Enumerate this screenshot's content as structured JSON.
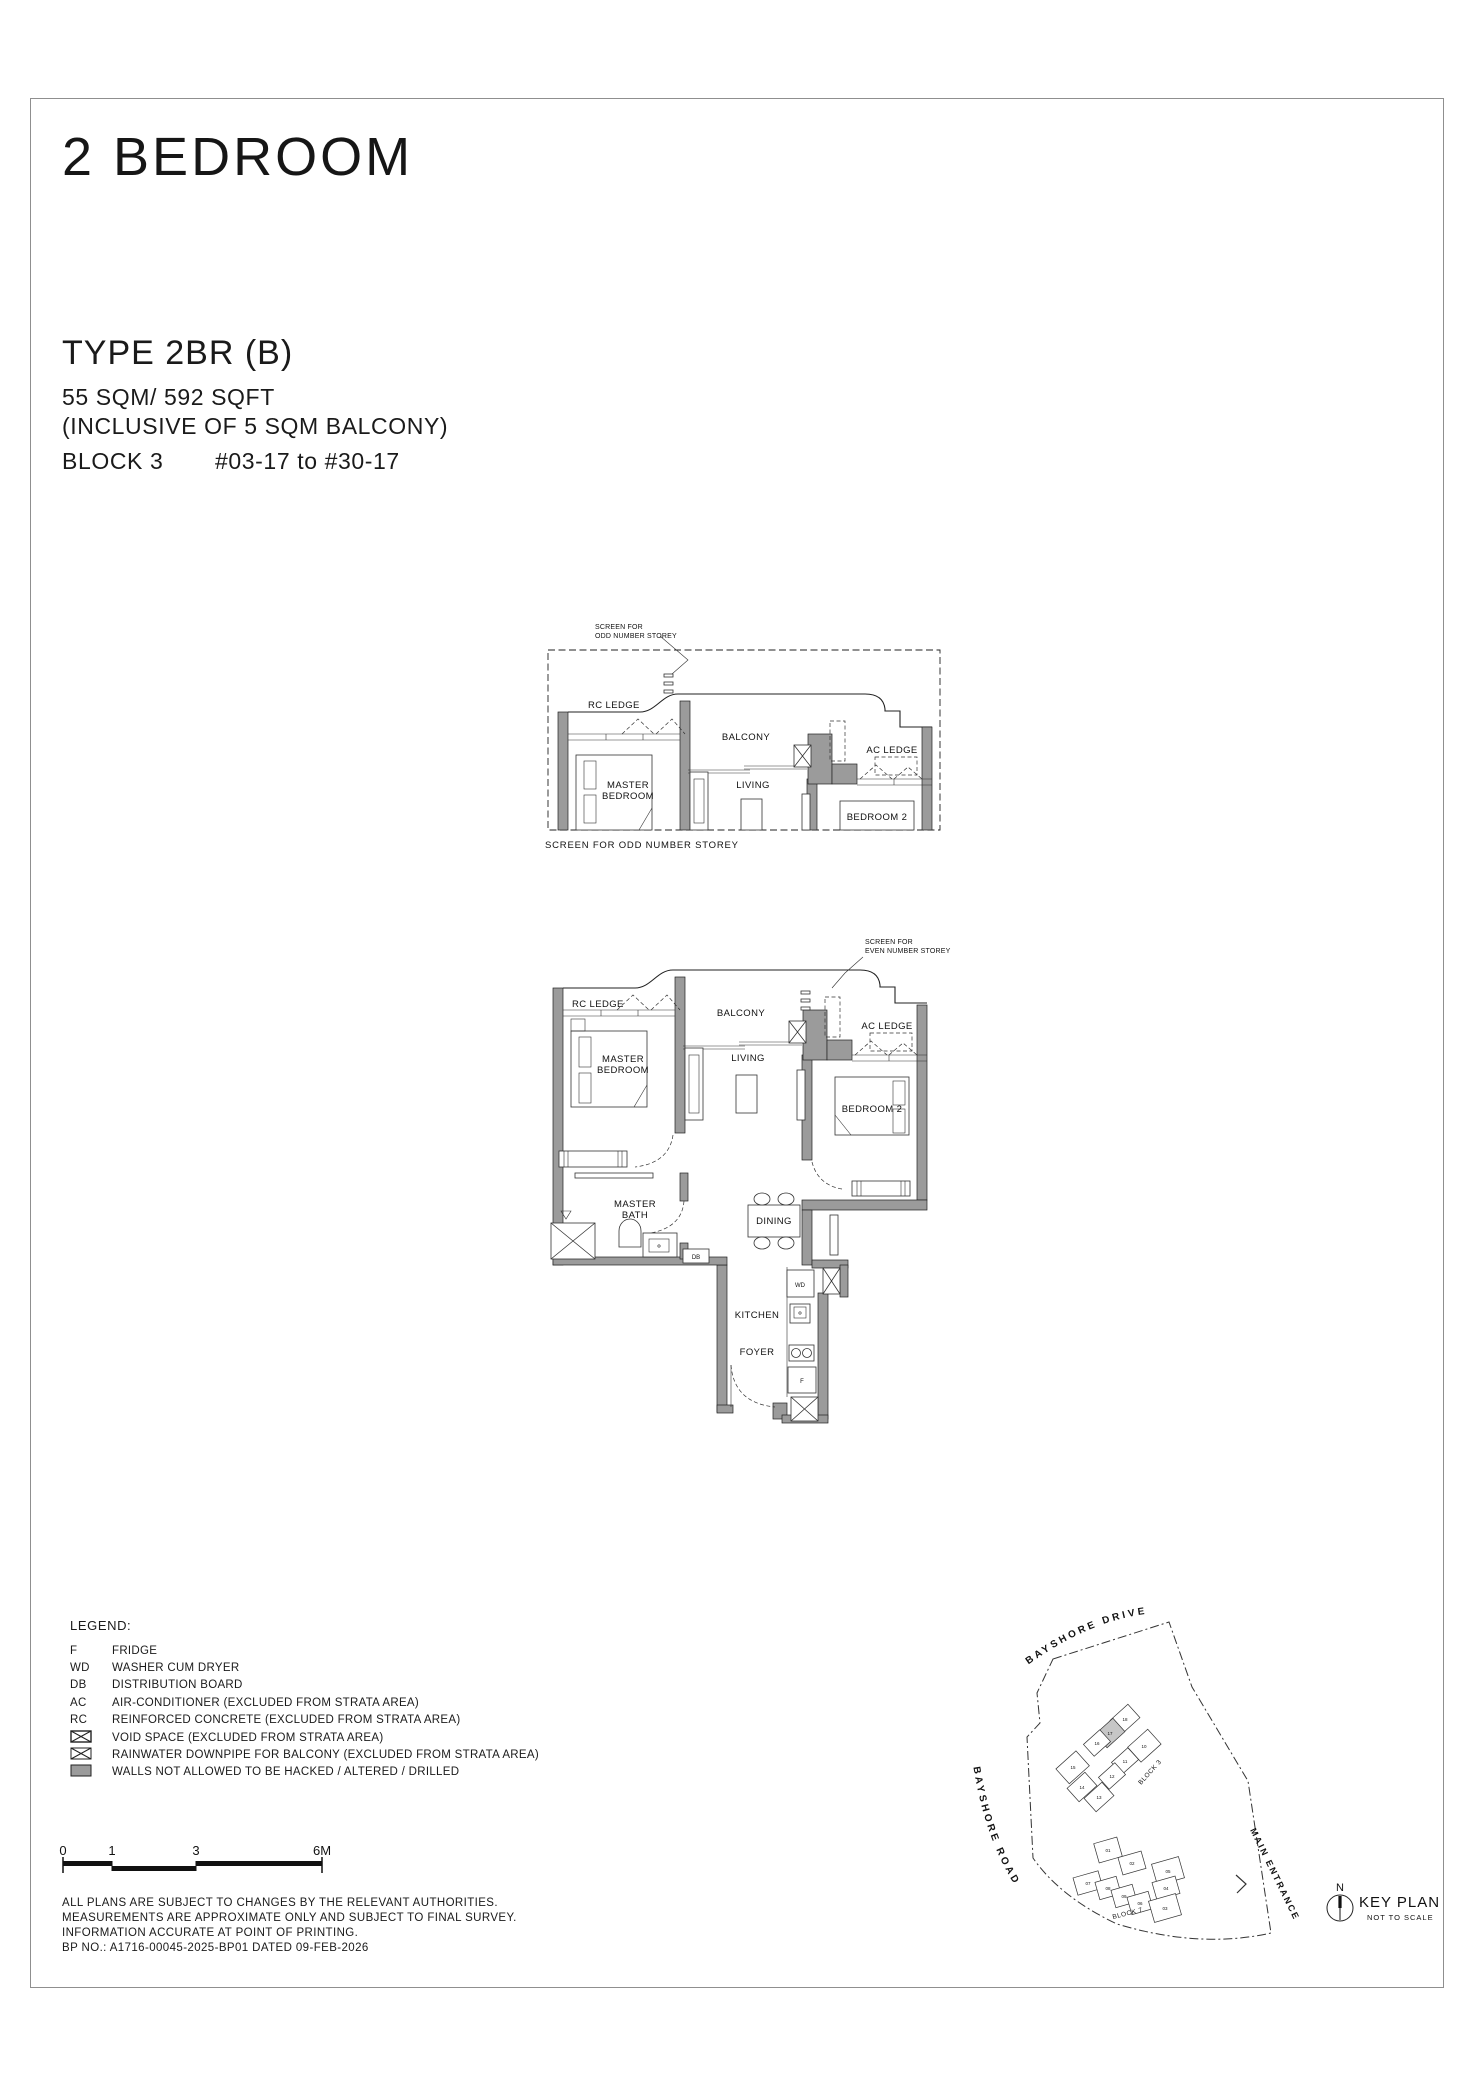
{
  "header": {
    "title": "2 BEDROOM",
    "type_name": "TYPE 2BR (B)",
    "area": "55 SQM/ 592 SQFT",
    "area_note": "(INCLUSIVE OF 5 SQM BALCONY)",
    "block": "BLOCK 3",
    "stack": "#03-17 to #30-17"
  },
  "plan_odd": {
    "annotation": [
      "SCREEN FOR",
      "ODD NUMBER STOREY"
    ],
    "caption": "SCREEN FOR ODD NUMBER STOREY",
    "labels": {
      "rc_ledge": "RC LEDGE",
      "balcony": "BALCONY",
      "ac_ledge": "AC LEDGE",
      "master_bedroom": [
        "MASTER",
        "BEDROOM"
      ],
      "living": "LIVING",
      "bedroom2": "BEDROOM 2"
    }
  },
  "plan_even": {
    "annotation": [
      "SCREEN FOR",
      "EVEN NUMBER STOREY"
    ],
    "labels": {
      "rc_ledge": "RC LEDGE",
      "balcony": "BALCONY",
      "ac_ledge": "AC LEDGE",
      "master_bedroom": [
        "MASTER",
        "BEDROOM"
      ],
      "living": "LIVING",
      "bedroom2": "BEDROOM 2",
      "master_bath": [
        "MASTER",
        "BATH"
      ],
      "dining": "DINING",
      "kitchen": "KITCHEN",
      "foyer": "FOYER",
      "wd": "WD",
      "db": "DB",
      "f": "F"
    }
  },
  "legend": {
    "heading": "LEGEND:",
    "items": [
      {
        "key": "F",
        "icon": "",
        "desc": "FRIDGE"
      },
      {
        "key": "WD",
        "icon": "",
        "desc": "WASHER CUM DRYER"
      },
      {
        "key": "DB",
        "icon": "",
        "desc": "DISTRIBUTION BOARD"
      },
      {
        "key": "AC",
        "icon": "",
        "desc": "AIR-CONDITIONER (EXCLUDED FROM STRATA AREA)"
      },
      {
        "key": "RC",
        "icon": "",
        "desc": "REINFORCED CONCRETE (EXCLUDED FROM STRATA AREA)"
      },
      {
        "key": "",
        "icon": "void-space-box",
        "desc": "VOID SPACE (EXCLUDED FROM STRATA AREA)"
      },
      {
        "key": "",
        "icon": "rainwater-downpipe-box",
        "desc": "RAINWATER DOWNPIPE FOR BALCONY (EXCLUDED FROM STRATA AREA)"
      },
      {
        "key": "",
        "icon": "shaded-wall-box",
        "desc": "WALLS NOT ALLOWED TO BE HACKED / ALTERED / DRILLED"
      }
    ]
  },
  "scalebar": {
    "ticks": [
      "0",
      "1",
      "3",
      "6M"
    ]
  },
  "footnotes": {
    "lines": [
      "ALL PLANS ARE SUBJECT TO CHANGES BY THE RELEVANT AUTHORITIES.",
      "MEASUREMENTS ARE APPROXIMATE ONLY AND SUBJECT TO FINAL SURVEY.",
      "INFORMATION ACCURATE AT POINT OF PRINTING.",
      "BP NO.: A1716-00045-2025-BP01 DATED 09-FEB-2026"
    ]
  },
  "keyplan": {
    "roads": {
      "top": "BAYSHORE DRIVE",
      "left": "BAYSHORE ROAD",
      "entrance": "MAIN ENTRANCE"
    },
    "block3_label": "BLOCK 3",
    "block7_label": "BLOCK 7",
    "block3_units": [
      "18",
      "17",
      "16",
      "10",
      "15",
      "11",
      "12",
      "14",
      "13"
    ],
    "block7_units": [
      "01",
      "02",
      "05",
      "07",
      "08",
      "04",
      "09",
      "06",
      "03"
    ],
    "highlight_unit": "17",
    "highlight_color": "#c6c6c6",
    "north_label": "N",
    "title": "KEY PLAN",
    "subtitle": "NOT TO SCALE"
  }
}
